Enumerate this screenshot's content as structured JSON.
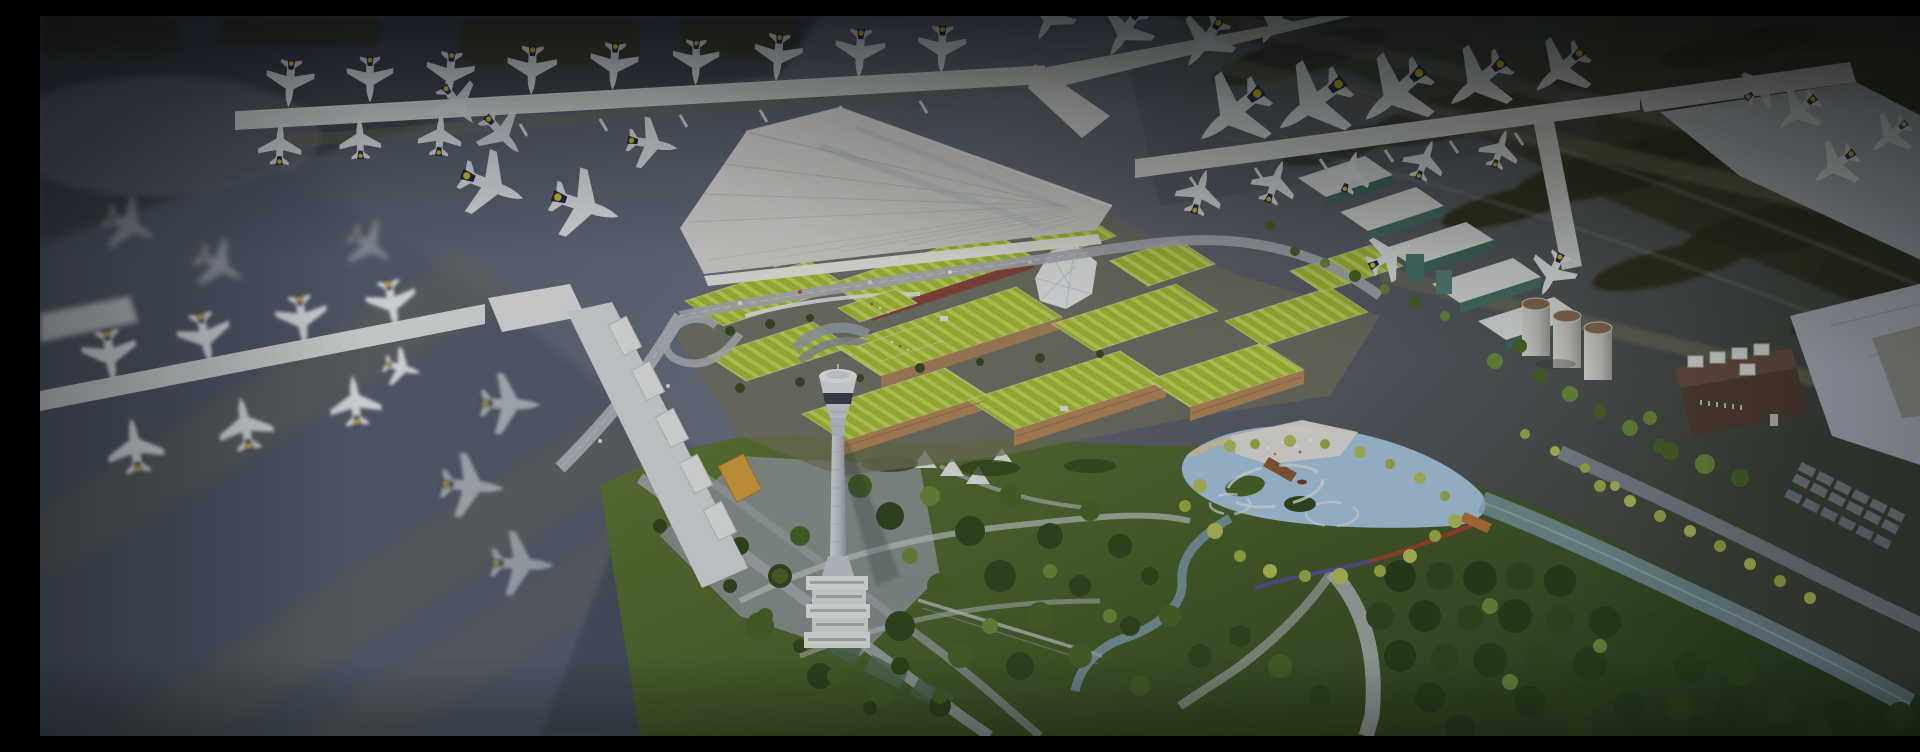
{
  "meta": {
    "type": "static-hero-image",
    "image_width": 1920,
    "image_height": 720,
    "description": "Aerial dusk rendering of an airport masterplan: a white fan-roofed terminal with X-shaped piers lined with parked jets bearing navy tails with yellow dots, a district of lime-green terraced roofs, an air traffic control tower, a landscaped park with a lake, palm trees and winding paths, fuel silos and a dark plant building on the right, and blurred runways, taxiways and aprons around the edges, all under a dark vignette overlay.",
    "visible_text": []
  },
  "palette": {
    "tarmac": "#636a79",
    "tarmac-dark": "#474c59",
    "runway-olive": "#3f422a",
    "grass-island": "#2c2f1a",
    "taxiway-tan": "#77765e",
    "terminal-white": "#eeede8",
    "pier-white": "#e2e5e4",
    "green-roof": "#a6bf37",
    "green-roof-light": "#c6d95c",
    "facade-tan": "#b4895a",
    "facade-red": "#8d4236",
    "tree-dark": "#33491f",
    "tree-mid": "#4a6628",
    "tree-light": "#6d8c3c",
    "palm-yellow": "#b4bf5a",
    "lake-blue": "#a9c8de",
    "water-dusk": "#8aa4ba",
    "path-gray": "#c6cacd",
    "sand": "#d8c9a4",
    "tail-navy": "#20284a",
    "tail-yellow": "#e3c51f",
    "tower-white": "#dfe3e6",
    "silo-top-brown": "#8a6a50",
    "brick-dark": "#544034",
    "hangar-pale": "#c2c8d3",
    "overlay-ink": "#0a0d14"
  }
}
